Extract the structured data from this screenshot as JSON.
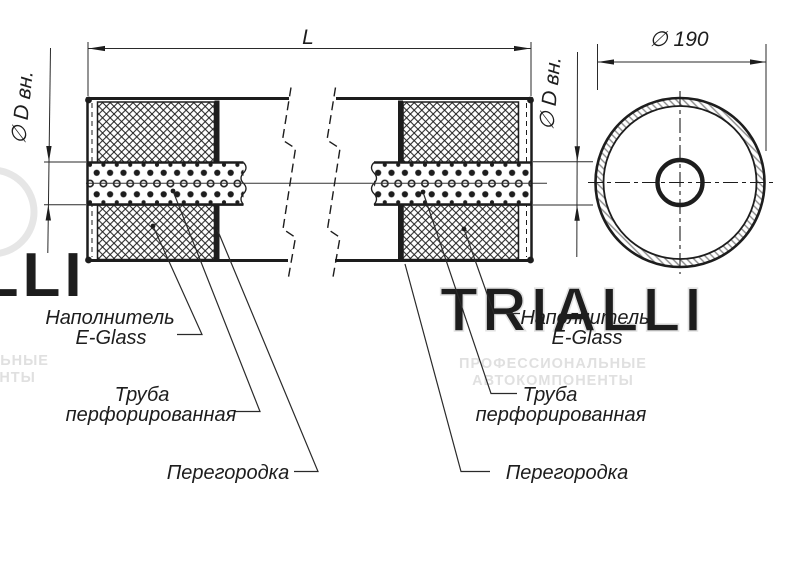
{
  "dimensions": {
    "length": {
      "label": "L"
    },
    "inner_diameter": {
      "label": "∅ D вн."
    },
    "outer_diameter": {
      "label": "∅ 190"
    }
  },
  "callouts": {
    "filler": {
      "line1": "Наполнитель",
      "line2": "E-Glass"
    },
    "perforated_pipe": {
      "line1": "Труба",
      "line2": "перфорированная"
    },
    "baffle": {
      "label": "Перегородка"
    }
  },
  "watermark": {
    "brand": "TRIALLI",
    "tagline_line1": "ПРОФЕССИОНАЛЬНЫЕ",
    "tagline_line2": "АВТОКОМПОНЕНТЫ"
  },
  "colors": {
    "line": "#1d1d1d",
    "thin_line": "#2a2a2a",
    "watermark": "#e2e2e2",
    "background": "#ffffff"
  }
}
